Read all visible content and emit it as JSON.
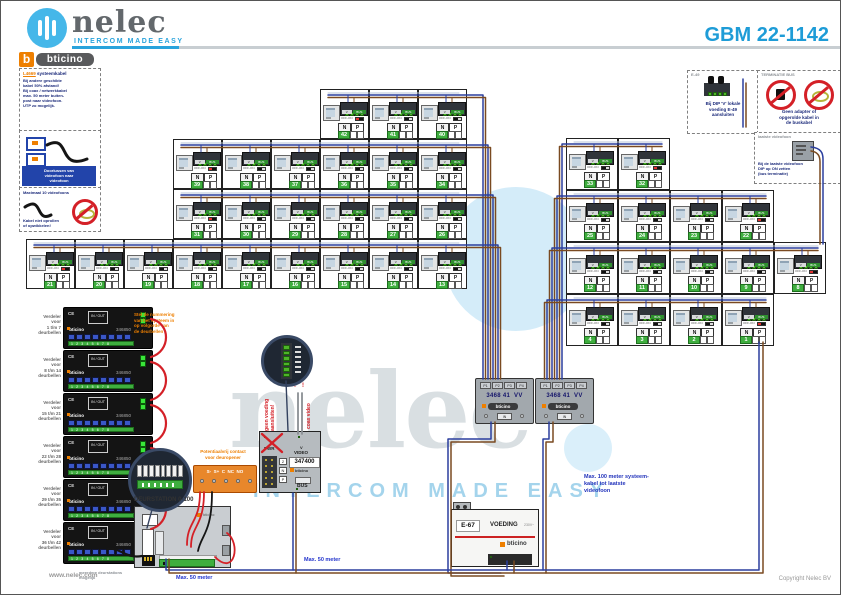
{
  "header": {
    "brand": "nelec",
    "brand_tagline": "INTERCOM MADE EASY",
    "bticino_b": "b",
    "bticino": "bticino",
    "code": "GBM 22-1142"
  },
  "notes_left": [
    {
      "title_accent": "L4669",
      "title": " systeemkabel",
      "lines": [
        "Bij andere geschikte",
        "kabel 50% afstand!",
        "Bij coax / netwerkkabel",
        "max. 50 meter buiten-",
        "post naar videofoon.",
        "UTP zo mogelijk."
      ]
    },
    {
      "caption_lines": [
        "Doorlussen van",
        "videofoon naar",
        "videofoon"
      ]
    },
    {
      "title": "Maximaal 10 videofoons",
      "caption_lines": [
        "Kabel niet oprollen",
        "of opwikkelen!"
      ]
    }
  ],
  "insets_right": [
    {
      "code": "E-49",
      "caption_lines": [
        "Bij DIP 'V' lokale",
        "voeding E-49",
        "aansluiten"
      ]
    },
    {
      "title": "TERMINATIE BUS",
      "caption_lines": [
        "Geen adapter of",
        "opgerolde kabel in",
        "de buskabel"
      ]
    },
    {
      "title": "laatste videofoon",
      "caption_lines": [
        "Bij de laatste videofoon",
        "DIP op ON zetten",
        "(bus terminatie)"
      ]
    }
  ],
  "unit_labels": {
    "n": "N",
    "p": "P",
    "v": "V",
    "bus": "BUS",
    "dip": "OFF-ON"
  },
  "left_grid": {
    "rows": [
      {
        "indent": 6,
        "units": [
          {
            "n": 42,
            "t": true
          },
          {
            "n": 41
          },
          {
            "n": 40
          }
        ]
      },
      {
        "indent": 3,
        "units": [
          {
            "n": 39,
            "t": true
          },
          {
            "n": 38
          },
          {
            "n": 37
          },
          {
            "n": 36
          },
          {
            "n": 35
          },
          {
            "n": 34
          }
        ]
      },
      {
        "indent": 3,
        "units": [
          {
            "n": 31,
            "t": true
          },
          {
            "n": 30
          },
          {
            "n": 29
          },
          {
            "n": 28
          },
          {
            "n": 27
          },
          {
            "n": 26
          }
        ]
      },
      {
        "indent": 0,
        "units": [
          {
            "n": 21,
            "t": true
          },
          {
            "n": 20
          },
          {
            "n": 19
          },
          {
            "n": 18
          },
          {
            "n": 17
          },
          {
            "n": 16
          },
          {
            "n": 15
          },
          {
            "n": 14
          },
          {
            "n": 13
          }
        ]
      }
    ]
  },
  "right_grid": {
    "rows": [
      {
        "units": [
          {
            "n": 33
          },
          {
            "n": 32,
            "t": true
          }
        ]
      },
      {
        "units": [
          {
            "n": 25
          },
          {
            "n": 24
          },
          {
            "n": 23
          },
          {
            "n": 22,
            "t": true
          }
        ]
      },
      {
        "units": [
          {
            "n": 12
          },
          {
            "n": 11
          },
          {
            "n": 10
          },
          {
            "n": 9
          },
          {
            "n": 8,
            "t": true
          }
        ]
      },
      {
        "units": [
          {
            "n": 4
          },
          {
            "n": 3
          },
          {
            "n": 2
          },
          {
            "n": 1,
            "t": true
          }
        ]
      }
    ]
  },
  "riser_modules": {
    "article": "346850",
    "brand": "bticino",
    "ce": "CE",
    "io": "IN / OUT",
    "terminal_numbers": "1 2 3 4 5 6 7 8",
    "labels": [
      [
        "Verdeler",
        "voor",
        "1 t/m 7",
        "deurbellen"
      ],
      [
        "Verdeler",
        "voor",
        "8 t/m 14",
        "deurbellen"
      ],
      [
        "Verdeler",
        "voor",
        "15 t/m 21",
        "deurbellen"
      ],
      [
        "Verdeler",
        "voor",
        "22 t/m 28",
        "deurbellen"
      ],
      [
        "Verdeler",
        "voor",
        "29 t/m 35",
        "deurbellen"
      ],
      [
        "Verdeler",
        "voor",
        "36 t/m 42",
        "deurbellen"
      ]
    ]
  },
  "orange_note_lines": [
    "Stel de nummering",
    "van het systeem in",
    "op volgorde van",
    "de deurbellen"
  ],
  "distributor": {
    "article": "3468 41",
    "suffix": "VV",
    "ports": [
      "P1",
      "P2",
      "P3",
      "P4"
    ],
    "in_label": "IN",
    "brand": "bticino",
    "count": 2
  },
  "door_panel": {
    "article": "347400",
    "pwr": "PWR",
    "video": "VIDEO",
    "v": "V",
    "bus": "BUS",
    "brand": "bticino",
    "terminals": [
      "2",
      "N",
      "P"
    ],
    "warn_left": "geen voeding aansluiten!",
    "warn_right": "coax video",
    "warn_marks": "!"
  },
  "relay_block": {
    "labels": "S-  S+  C  NC  NO",
    "caption_lines": [
      "Potentiaalvrij contact",
      "voor deuropener"
    ]
  },
  "door_station": {
    "caption": "DEURSTATION 0-100",
    "note_lines": [
      "meerdere deurstations",
      "mogelijk"
    ]
  },
  "psu": {
    "code": "E-67",
    "name": "VOEDING",
    "mains": "230V~",
    "brand": "bticino"
  },
  "wire_labels": [
    {
      "text": "Max. 50 meter",
      "x": 175,
      "y": 574
    },
    {
      "text": "Max. 50 meter",
      "x": 303,
      "y": 556
    }
  ],
  "bus_note_lines": [
    "Max. 100 meter systeem-",
    "kabel tot laatste",
    "videofoon"
  ],
  "watermark": {
    "word": "nelec",
    "tagline": "INTERCOM MADE EASY"
  },
  "footer": {
    "url": "www.nelec.com",
    "copyright": "Copyright Nelec BV"
  },
  "colors": {
    "accent": "#1e9cd7",
    "orange": "#ee7f00",
    "green": "#3fae3f",
    "terminal_green": "#4db528",
    "wire_blue": "#2b3f9e",
    "wire_brown": "#7a4a21",
    "wire_red": "#d42027",
    "navy": "#1b2a7a"
  }
}
